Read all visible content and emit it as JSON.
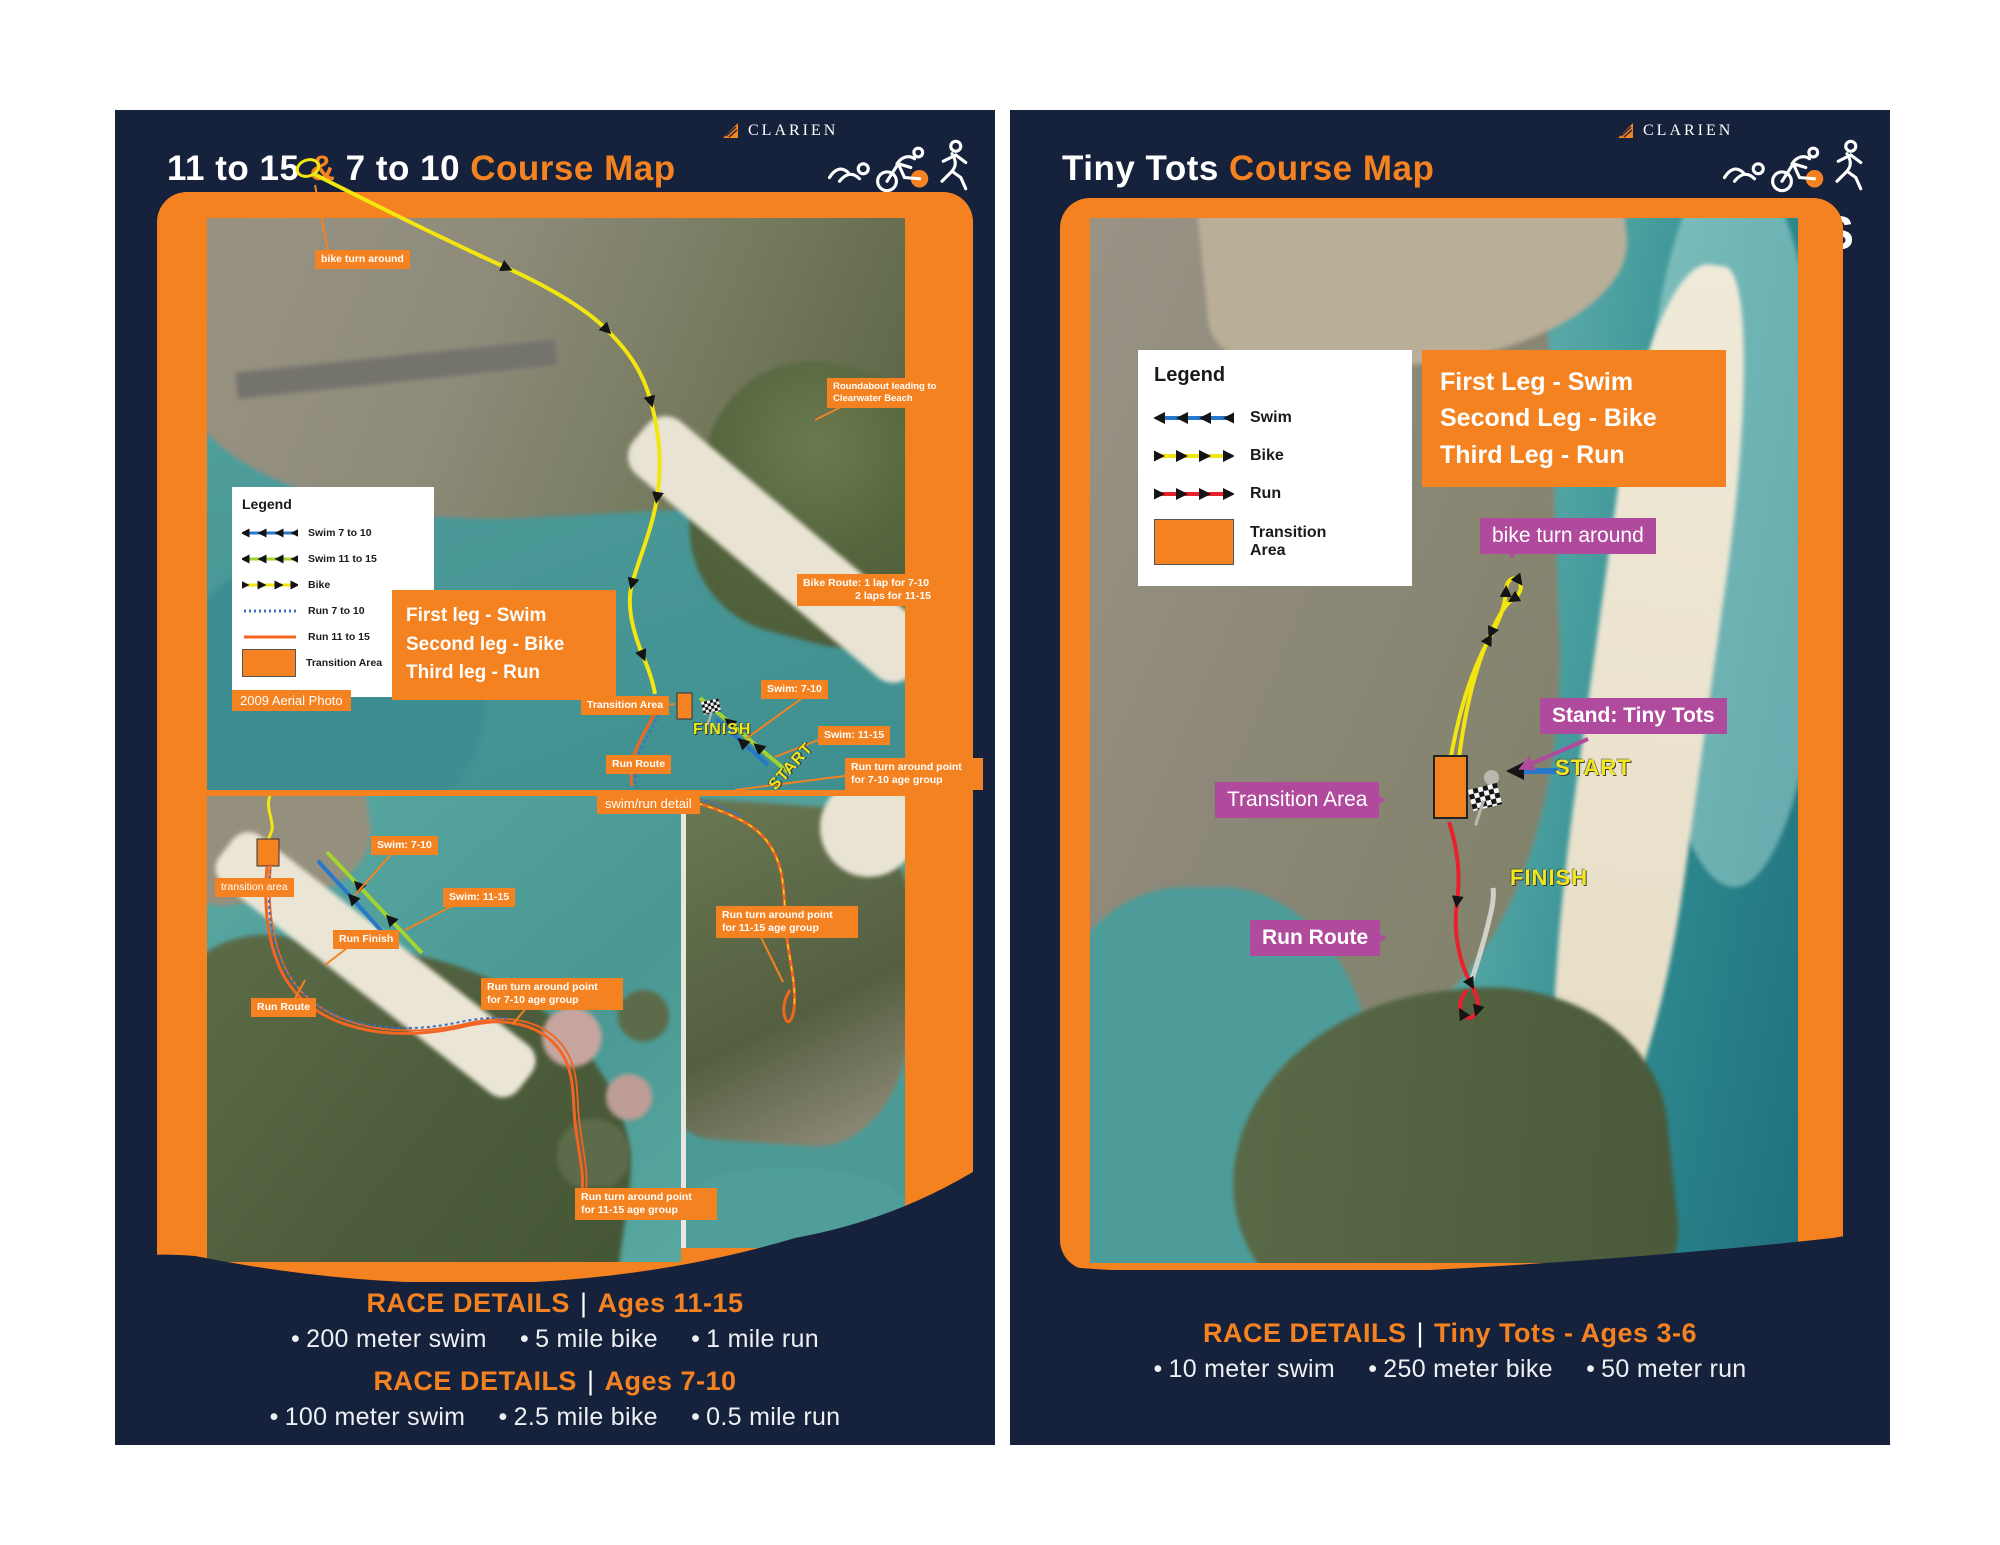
{
  "shared": {
    "bullet": "•",
    "pipe": "|",
    "brand": {
      "clarien": "CLARIEN",
      "iron_left": "IRON K",
      "iron_right": "DS"
    },
    "colors": {
      "navy": "#16213c",
      "orange": "#f58220",
      "purple": "#b04a9c",
      "bike_yellow": "#f3e50f",
      "swim_blue": "#2778c8",
      "swim_green": "#a4d233",
      "run_red": "#e8212c",
      "run_orange": "#f26522",
      "run_dotted_blue": "#3a6fc4",
      "yellow_text": "#f2e71c"
    }
  },
  "left": {
    "title": {
      "ages_a": "11 to 15",
      "amp": " & ",
      "ages_b": "7 to 10 ",
      "suffix": "Course Map"
    },
    "legend": {
      "title": "Legend",
      "items": [
        {
          "label": "Swim 7 to 10",
          "color": "#2778c8",
          "style": "arrow-left"
        },
        {
          "label": "Swim 11 to 15",
          "color": "#a4d233",
          "style": "arrow-left"
        },
        {
          "label": "Bike",
          "color": "#f3e50f",
          "style": "arrow-right"
        },
        {
          "label": "Run 7 to 10",
          "color": "#3a6fc4",
          "style": "dotted"
        },
        {
          "label": "Run 11 to 15",
          "color": "#f26522",
          "style": "solid"
        },
        {
          "label": "Transition Area",
          "color": "#f58220",
          "style": "swatch"
        }
      ]
    },
    "aerial_note": "2009 Aerial Photo",
    "legs_box": {
      "line1": "First leg - Swim",
      "line2": "Second leg - Bike",
      "line3": "Third leg - Run"
    },
    "map_labels": {
      "bike_turn_around": "bike turn around",
      "roundabout_1": "Roundabout leading to",
      "roundabout_2": "Clearwater Beach",
      "bike_route_title": "Bike Route:",
      "bike_route_line1": "1 lap for 7-10",
      "bike_route_line2": "2 laps for 11-15",
      "transition_area": "Transition Area",
      "swim_7_10": "Swim: 7-10",
      "swim_11_15": "Swim: 11-15",
      "run_route": "Run Route",
      "run_turn_7_10_a": "Run turn around point",
      "run_turn_7_10_b": "for 7-10 age group",
      "finish": "FINISH",
      "start": "START",
      "detail_title": "swim/run detail"
    },
    "detail_labels": {
      "transition_area": "transition area",
      "swim_7_10": "Swim: 7-10",
      "swim_11_15": "Swim: 11-15",
      "run_finish": "Run Finish",
      "run_route": "Run Route",
      "run_turn_7_10_a": "Run turn around point",
      "run_turn_7_10_b": "for 7-10 age group",
      "run_turn_11_15_a": "Run turn around point",
      "run_turn_11_15_b": "for 11-15 age group"
    },
    "strip_labels": {
      "run_turn_11_15_a": "Run turn around point",
      "run_turn_11_15_b": "for 11-15 age group"
    },
    "race_details": [
      {
        "heading": "RACE DETAILS",
        "group": "Ages 11-15",
        "stats": [
          "200 meter swim",
          "5 mile bike",
          "1 mile run"
        ]
      },
      {
        "heading": "RACE DETAILS",
        "group": "Ages 7-10",
        "stats": [
          "100 meter swim",
          "2.5 mile bike",
          "0.5 mile run"
        ]
      }
    ]
  },
  "right": {
    "title": {
      "prefix": "Tiny Tots ",
      "suffix": "Course Map"
    },
    "legend": {
      "title": "Legend",
      "items": [
        {
          "label": "Swim",
          "color": "#2778c8",
          "style": "arrow-left"
        },
        {
          "label": "Bike",
          "color": "#f3e50f",
          "style": "arrow-right"
        },
        {
          "label": "Run",
          "color": "#e8212c",
          "style": "arrow-right"
        },
        {
          "label": "Transition Area",
          "color": "#f58220",
          "style": "swatch"
        }
      ]
    },
    "legs_box": {
      "line1": "First Leg - Swim",
      "line2": "Second Leg - Bike",
      "line3": "Third Leg - Run"
    },
    "map_labels": {
      "bike_turn_around": "bike turn around",
      "stand": "Stand: Tiny Tots",
      "start": "START",
      "transition_area": "Transition Area",
      "finish": "FINISH",
      "run_route": "Run Route"
    },
    "race_details": {
      "heading": "RACE DETAILS",
      "group": "Tiny Tots - Ages 3-6",
      "stats": [
        "10 meter swim",
        "250 meter bike",
        "50 meter run"
      ]
    }
  }
}
